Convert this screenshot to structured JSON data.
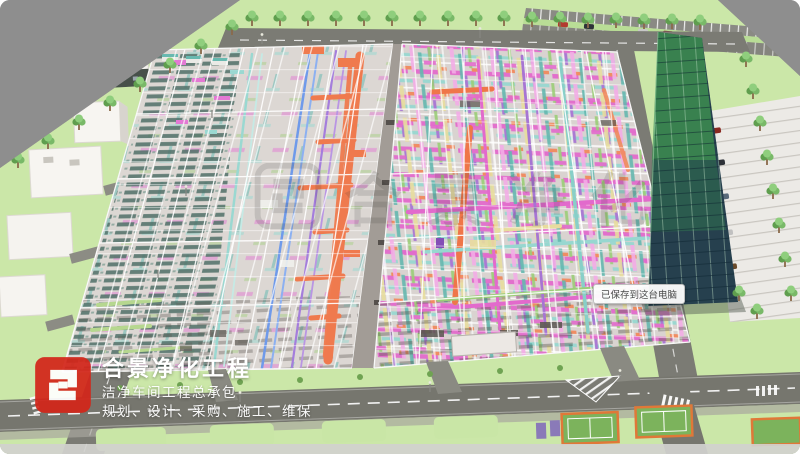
{
  "branding": {
    "company_name": "合景净化工程",
    "tagline_1": "洁净车间工程总承包",
    "tagline_2": "规划、设计、采购、施工、维保",
    "logo_color": "#d3261a"
  },
  "watermark": {
    "text": "合景净化"
  },
  "toast": {
    "message": "已保存到这台电脑"
  },
  "palette": {
    "outer_ground": "#8e8e8e",
    "lawn": "#cbe7a8",
    "road": "#7b7b74",
    "hall_floor": "#d9d3cf",
    "duct_orange": "#ee6b3a",
    "pipe_magenta": "#e05ec8",
    "pipe_pink": "#f2a6e4",
    "pipe_cyan": "#8fd4cc",
    "pipe_teal": "#57b2a8",
    "pipe_purple": "#a06ad0",
    "pipe_green": "#93c96c",
    "pipe_yellow": "#e6da96",
    "pipe_blue": "#5f8fe8",
    "equipment_teal": "#3c6057",
    "glass_green": "#3f9150",
    "glass_dark": "#26404e",
    "court_green": "#7cb35c",
    "court_border": "#e07838"
  }
}
